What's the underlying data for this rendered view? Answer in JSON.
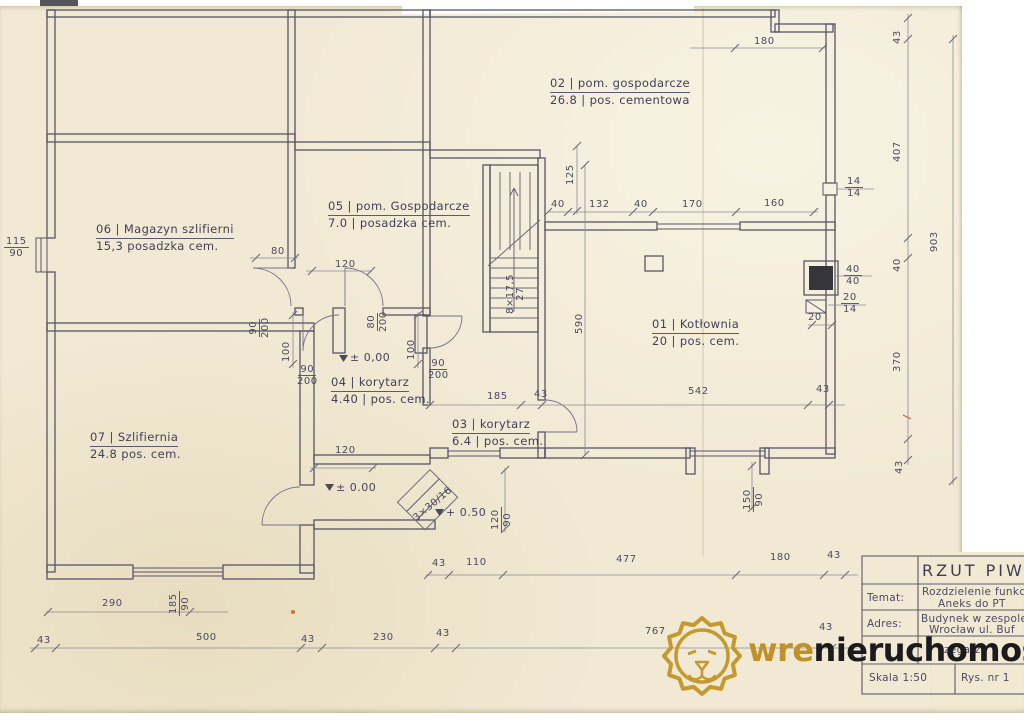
{
  "colors": {
    "paper": "#f1e9d4",
    "ink": "#565666",
    "dim": "#8a8a9a",
    "gold": "#c0912b",
    "dark_text": "#1b1b1d"
  },
  "rooms": {
    "r01": {
      "l1": "01 | Kotłownia",
      "l2": "20 | pos. cem."
    },
    "r02": {
      "l1": "02 | pom. gospodarcze",
      "l2": "26.8 | pos. cementowa"
    },
    "r03": {
      "l1": "03 | korytarz",
      "l2": "6.4 | pos. cem."
    },
    "r04": {
      "l1": "04 | korytarz",
      "l2": "4.40 | pos. cem."
    },
    "r05": {
      "l1": "05 | pom. Gospodarcze",
      "l2": "7.0 | posadzka cem."
    },
    "r06": {
      "l1": "06 | Magazyn szlifierni",
      "l2": "15,3 posadzka cem."
    },
    "r07": {
      "l1": "07 | Szlifiernia",
      "l2": "24.8 pos. cem."
    }
  },
  "dims": {
    "top180": "180",
    "right": {
      "a43": "43",
      "a407": "407",
      "a40": "40",
      "a370": "370",
      "b43": "43",
      "total": "903"
    },
    "open1414": [
      "14",
      "14"
    ],
    "chimney": [
      "40",
      "40"
    ],
    "flue": [
      "20",
      "14"
    ],
    "flue20": "20",
    "v125": "125",
    "k01top": [
      "40",
      "132",
      "40",
      "170",
      "160"
    ],
    "v590": "590",
    "winL": [
      "115",
      "90"
    ],
    "d80": "80",
    "d120": "120",
    "d120b": "120",
    "doorA": [
      "90",
      "200"
    ],
    "doorB": [
      "80",
      "200"
    ],
    "doorC": [
      "90",
      "200"
    ],
    "doorD": [
      "90",
      "200"
    ],
    "v100a": "100",
    "v100b": "100",
    "mid": [
      "185",
      "43",
      "542",
      "43"
    ],
    "stairs": [
      "8×17,5",
      "27"
    ],
    "openR": [
      "150",
      "90"
    ],
    "ext": [
      "120",
      "90"
    ],
    "extNote": "3×30/16",
    "d290": "290",
    "winB": [
      "185",
      "90"
    ],
    "bottom": [
      "43",
      "500",
      "43",
      "230",
      "43",
      "767",
      "43"
    ],
    "rowA": [
      "43",
      "110",
      "477",
      "180",
      "43"
    ]
  },
  "levels": {
    "zero": "± 0,00",
    "zero2": "± 0.00",
    "half": "+ 0.50"
  },
  "title_block": {
    "title": "RZUT PIWN",
    "temat_label": "Temat:",
    "temat1": "Rozdzielenie funkc",
    "temat2": "Aneks do PT",
    "adres_label": "Adres:",
    "adres1": "Budynek w zespole",
    "adres2": "Wrocław ul. Buf",
    "row4": "zegarz",
    "skala": "Skala 1:50",
    "rys": "Rys. nr 1"
  },
  "watermark": {
    "gold_text": "wre",
    "dark_text": "nieruchomości"
  }
}
